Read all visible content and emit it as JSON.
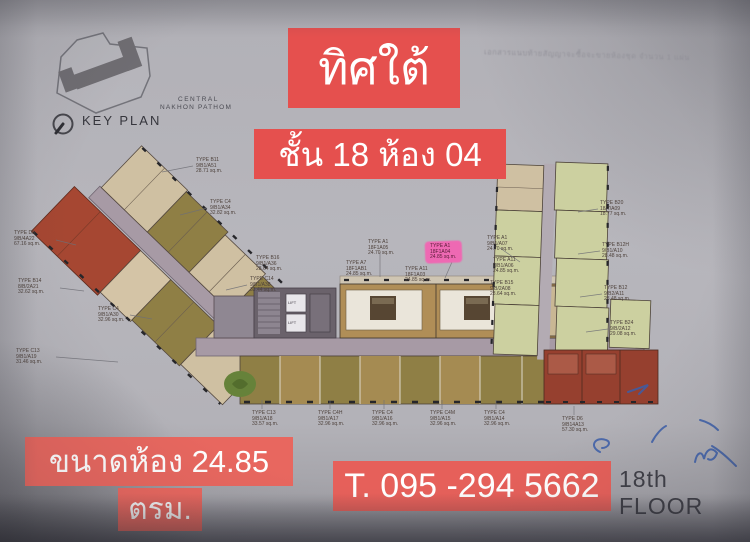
{
  "overlays": {
    "direction": "ทิศใต้",
    "floor_room": "ชั้น 18 ห้อง 04",
    "size_line1": "ขนาดห้อง  24.85",
    "size_line2": "ตรม.",
    "phone": "T. 095 -294 5662",
    "box_color_top": "#e5504e",
    "box_color_bottom": "#e8675f"
  },
  "floor_label": "18th FLOOR",
  "doc_header": "เอกสารแนบท้ายสัญญาจะซื้อจะขายห้องชุด จำนวน 1 แผ่น",
  "key_plan": {
    "label": "KEY PLAN",
    "project_line1": "CENTRAL",
    "project_line2": "NAKHON PATHOM"
  },
  "plan": {
    "lift_label": "LIFT",
    "highlight_unit": {
      "type": "TYPE A1",
      "code": "18F1A04",
      "area": "24.85 sq.m."
    },
    "highlight_color": "#f65fb2",
    "labels": [
      {
        "x": 196,
        "y": 158,
        "lines": [
          "TYPE B11",
          "9/B1/A51",
          "28.71 sq.m."
        ],
        "hl": false
      },
      {
        "x": 210,
        "y": 200,
        "lines": [
          "TYPE C4",
          "9/B1/A34",
          "32.82 sq.m."
        ],
        "hl": false
      },
      {
        "x": 14,
        "y": 231,
        "lines": [
          "TYPE D5",
          "9/B/4A22",
          "67.16 sq.m."
        ],
        "hl": false
      },
      {
        "x": 18,
        "y": 279,
        "lines": [
          "TYPE B14",
          "8/B/2A21",
          "32.62 sq.m."
        ],
        "hl": false
      },
      {
        "x": 250,
        "y": 277,
        "lines": [
          "TYPE C14",
          "9/B1/A38",
          "33.44 sq.m."
        ],
        "hl": false
      },
      {
        "x": 98,
        "y": 307,
        "lines": [
          "TYPE C4",
          "9/B1/A30",
          "32.96 sq.m."
        ],
        "hl": false
      },
      {
        "x": 16,
        "y": 349,
        "lines": [
          "TYPE C13",
          "9/B1/A19",
          "31.46 sq.m."
        ],
        "hl": false
      },
      {
        "x": 256,
        "y": 256,
        "lines": [
          "TYPE B16",
          "9/B1/A36",
          "28.64 sq.m."
        ],
        "hl": false
      },
      {
        "x": 346,
        "y": 261,
        "lines": [
          "TYPE A7",
          "18F1AB1",
          "24.85 sq.m."
        ],
        "hl": false
      },
      {
        "x": 368,
        "y": 240,
        "lines": [
          "TYPE A1",
          "18F1A05",
          "24.70 sq.m."
        ],
        "hl": false
      },
      {
        "x": 430,
        "y": 244,
        "lines": [
          "TYPE A1",
          "18F1A04",
          "24.85 sq.m."
        ],
        "hl": true
      },
      {
        "x": 487,
        "y": 236,
        "lines": [
          "TYPE A1",
          "9/B1/A07",
          "24.70 sq.m."
        ],
        "hl": false
      },
      {
        "x": 493,
        "y": 258,
        "lines": [
          "TYPE A11",
          "9/B1/A06",
          "24.85 sq.m."
        ],
        "hl": false
      },
      {
        "x": 405,
        "y": 267,
        "lines": [
          "TYPE A11",
          "18F1A03",
          "24.85 sq.m."
        ],
        "hl": false
      },
      {
        "x": 490,
        "y": 281,
        "lines": [
          "TYPE B15",
          "9/B/2A08",
          "28.64 sq.m."
        ],
        "hl": false
      },
      {
        "x": 600,
        "y": 201,
        "lines": [
          "TYPE B20",
          "18/7/A09",
          "18.77 sq.m."
        ],
        "hl": false
      },
      {
        "x": 602,
        "y": 243,
        "lines": [
          "TYPE B12H",
          "9/B1/A10",
          "28.48 sq.m."
        ],
        "hl": false
      },
      {
        "x": 604,
        "y": 286,
        "lines": [
          "TYPE B12",
          "9/B2/A11",
          "28.48 sq.m."
        ],
        "hl": false
      },
      {
        "x": 610,
        "y": 321,
        "lines": [
          "TYPE B24",
          "9/B/2A12",
          "29.08 sq.m."
        ],
        "hl": false
      },
      {
        "x": 252,
        "y": 411,
        "lines": [
          "TYPE C13",
          "9/B1/A18",
          "33.57 sq.m."
        ],
        "hl": false
      },
      {
        "x": 318,
        "y": 411,
        "lines": [
          "TYPE C4H",
          "9/B1/A17",
          "32.96 sq.m."
        ],
        "hl": false
      },
      {
        "x": 372,
        "y": 411,
        "lines": [
          "TYPE C4",
          "9/B1/A16",
          "32.96 sq.m."
        ],
        "hl": false
      },
      {
        "x": 430,
        "y": 411,
        "lines": [
          "TYPE C4M",
          "9/B1/A15",
          "32.96 sq.m."
        ],
        "hl": false
      },
      {
        "x": 484,
        "y": 411,
        "lines": [
          "TYPE C4",
          "9/B1/A14",
          "32.96 sq.m."
        ],
        "hl": false
      },
      {
        "x": 562,
        "y": 417,
        "lines": [
          "TYPE D6",
          "9/B14A13",
          "57.30 sq.m."
        ],
        "hl": false
      }
    ]
  }
}
